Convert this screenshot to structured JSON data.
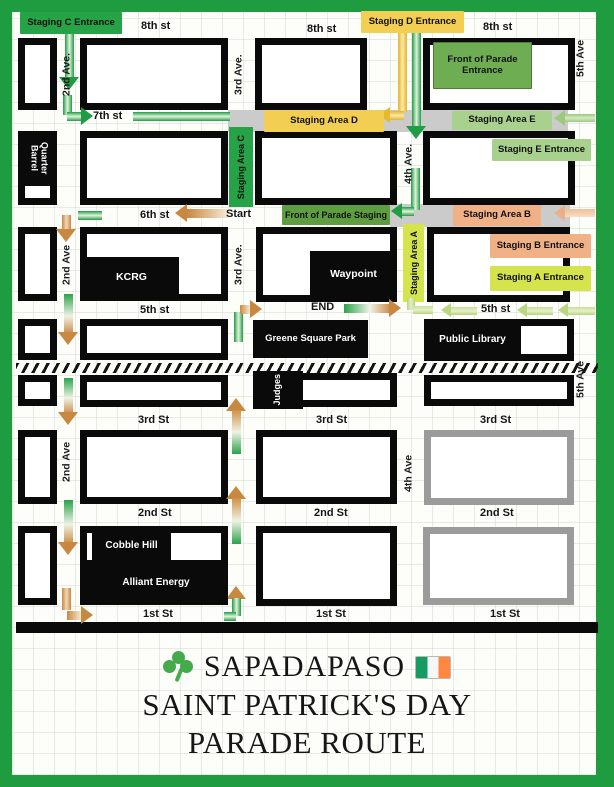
{
  "title": {
    "org": "SAPADAPASO",
    "line2": "SAINT PATRICK'S DAY",
    "line3": "PARADE ROUTE"
  },
  "icons": {
    "left_of_title": "shamrock-icon",
    "right_of_title": "ireland-flag-icon"
  },
  "route": {
    "start_label": "Start",
    "end_label": "END"
  },
  "streets": {
    "s8": [
      "8th st",
      "8th st",
      "8th st"
    ],
    "s7": "7th st",
    "s6": "6th st",
    "s5": [
      "5th st",
      "5th st"
    ],
    "s3": [
      "3rd St",
      "3rd St",
      "3rd St"
    ],
    "s2": [
      "2nd St",
      "2nd St",
      "2nd St"
    ],
    "s1": [
      "1st St",
      "1st St",
      "1st St"
    ]
  },
  "avenues": {
    "a2": [
      "2nd Ave.",
      "2nd Ave",
      "2nd Ave"
    ],
    "a3": [
      "3rd Ave.",
      "3rd Ave."
    ],
    "a4": [
      "4th Ave.",
      "4th Ave"
    ],
    "a5": [
      "5th Ave",
      "5th Ave"
    ]
  },
  "staging": {
    "c_entrance": "Staging C Entrance",
    "area_c": "Staging Area C",
    "d_entrance": "Staging D Entrance",
    "area_d": "Staging Area D",
    "area_e": "Staging Area E",
    "e_entrance": "Staging E Entrance",
    "front_entrance": "Front of Parade Entrance",
    "front_staging": "Front of Parade Staging",
    "area_b": "Staging Area B",
    "b_entrance": "Staging B Entrance",
    "area_a": "Staging Area A",
    "a_entrance": "Staging A Entrance"
  },
  "places": {
    "quarter_barrel": "Quarter Barrel",
    "kcrg": "KCRG",
    "waypoint": "Waypoint",
    "greene_square_park": "Greene Square Park",
    "public_library": "Public Library",
    "judges": "Judges",
    "cobble_hill": "Cobble Hill",
    "alliant_energy": "Alliant Energy"
  },
  "colors": {
    "frame_green": "#1f9c40",
    "route_green": "#27a347",
    "staging_d_yellow": "#f2cf53",
    "staging_e_light_green": "#a9d18e",
    "parade_front_green": "#6fad52",
    "parade_staging_green": "#5f9e3f",
    "staging_b_orange": "#f0b186",
    "staging_a_yellow_green": "#d5e44c",
    "arrow_orange": "#c9883f",
    "block_black": "#0a0a0a",
    "block_gray": "#9b9b9b",
    "road_gray": "#cbcbcb"
  }
}
